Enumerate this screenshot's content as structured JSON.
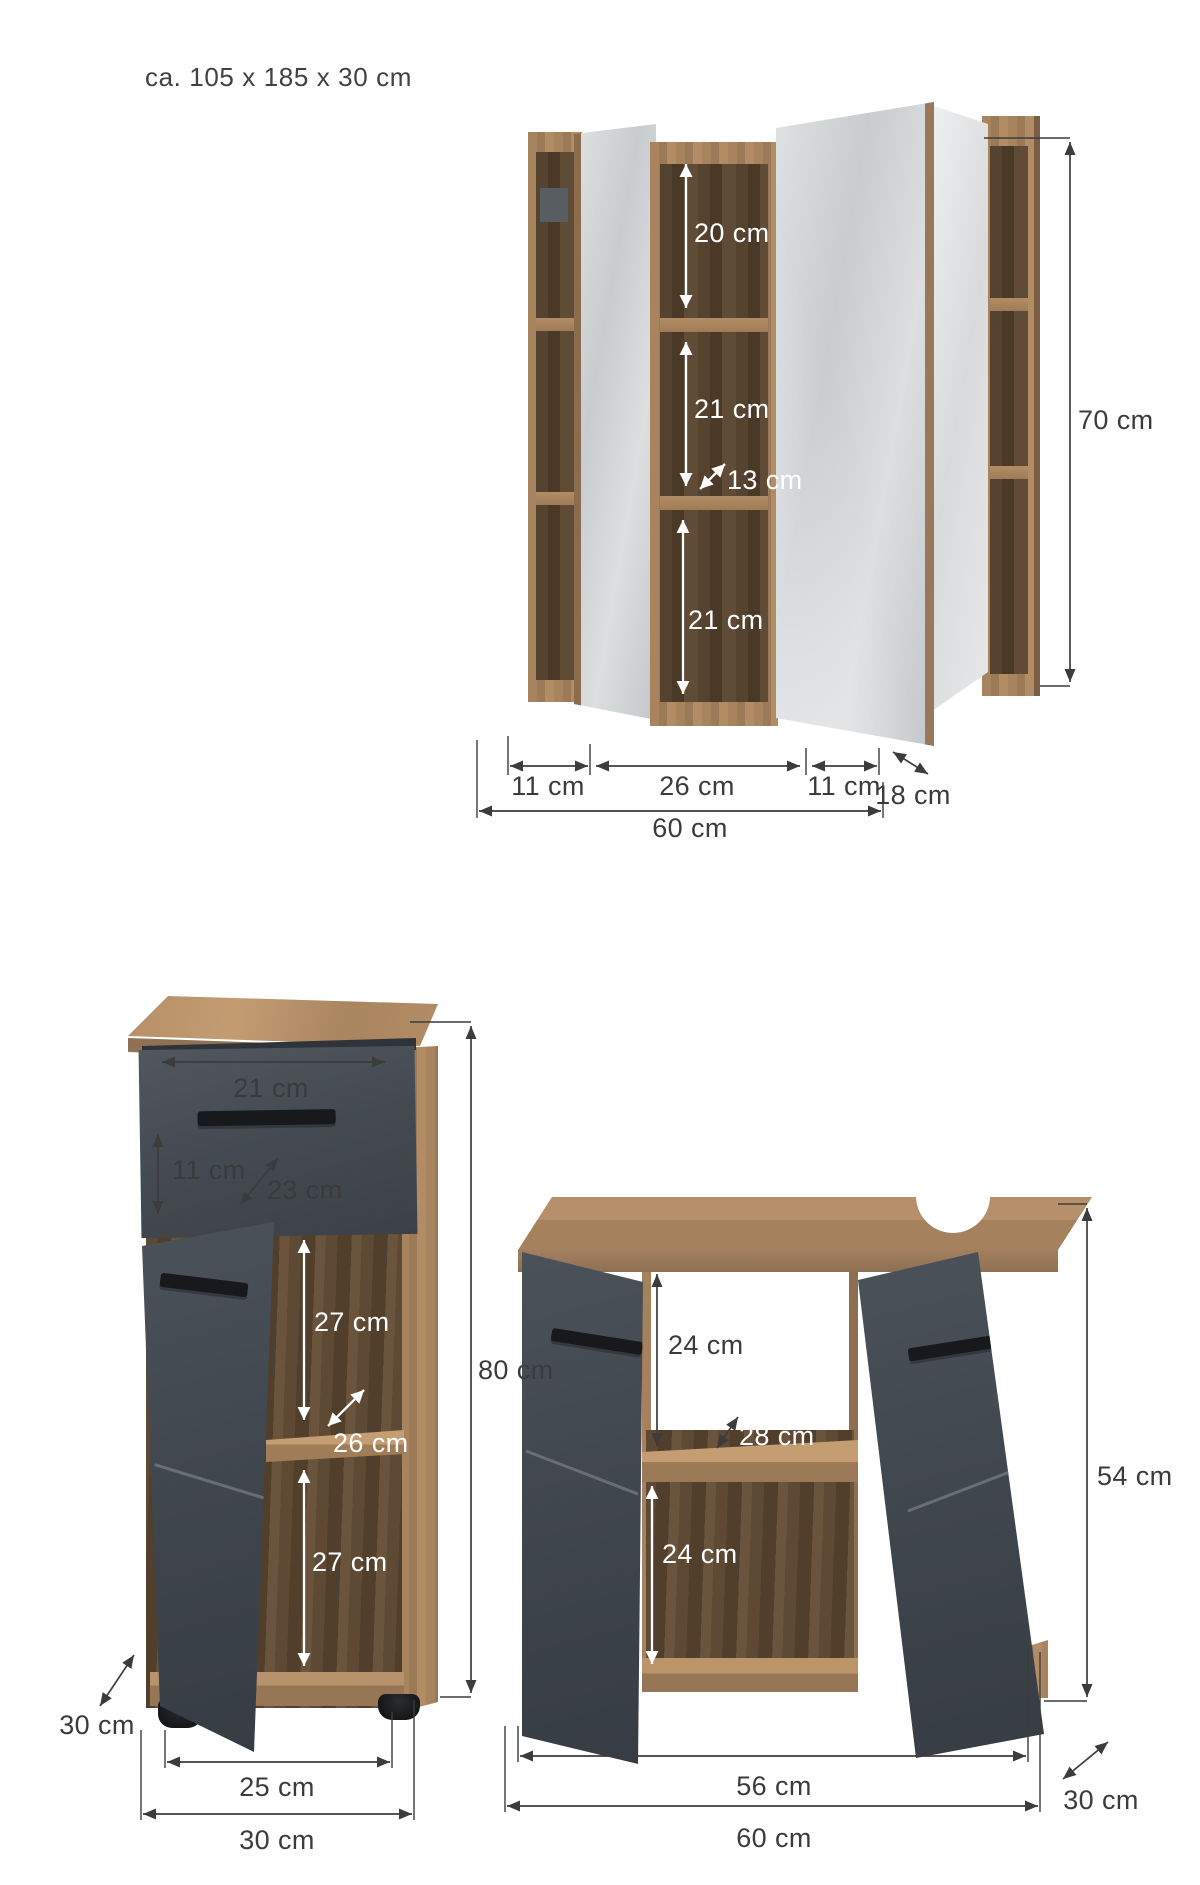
{
  "title": "ca. 105 x 185 x 30 cm",
  "colors": {
    "background": "#ffffff",
    "wood": "#a8845e",
    "wood_dark_interior": "#53412e",
    "mirror": "#d5d8da",
    "anthracite_front": "#454b52",
    "dimension_line": "#3c3c3c",
    "dimension_text_dark": "#3b3b3b",
    "dimension_text_light": "#ffffff"
  },
  "figures": {
    "mirror_cabinet": {
      "name": "Mirror cabinet",
      "dims": {
        "top_shelf_height": "20 cm",
        "middle_shelf_height": "21 cm",
        "inner_depth": "13 cm",
        "bottom_shelf_height": "21 cm",
        "total_height": "70 cm",
        "left_door_width": "11 cm",
        "middle_section_width": "26 cm",
        "right_door_width": "11 cm",
        "total_width": "60 cm",
        "total_depth": "18 cm"
      }
    },
    "base_cabinet": {
      "name": "Base cabinet",
      "dims": {
        "drawer_width": "21 cm",
        "drawer_front_height": "11 cm",
        "drawer_depth": "23 cm",
        "upper_compartment_height": "27 cm",
        "shelf_depth": "26 cm",
        "lower_compartment_height": "27 cm",
        "total_height": "80 cm",
        "total_depth": "30 cm",
        "door_width": "25 cm",
        "total_width": "30 cm"
      }
    },
    "vanity_cabinet": {
      "name": "Washbasin cabinet",
      "dims": {
        "upper_compartment_height": "24 cm",
        "shelf_depth": "28 cm",
        "lower_compartment_height": "24 cm",
        "total_height": "54 cm",
        "inner_width": "56 cm",
        "total_width": "60 cm",
        "total_depth": "30 cm"
      }
    }
  }
}
